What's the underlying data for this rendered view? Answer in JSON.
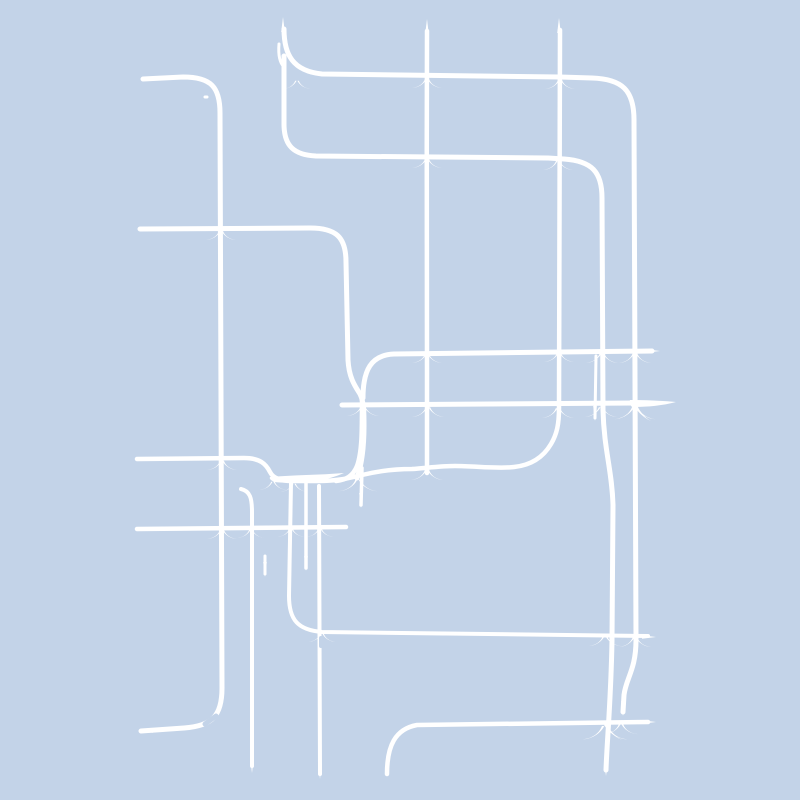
{
  "page": {
    "title": "Abstract white pipe-line artwork on pale blue background"
  },
  "canvas": {
    "width": 800,
    "height": 800,
    "background_color": "#c3d3e8",
    "line_color": "#ffffff"
  },
  "artwork": {
    "description": "Abstract generative line art: a tangle of white pipe-like lines with rounded corners, tapered needle ends and calligraphic claw flares at intersections, drawn on a pale periwinkle-blue background",
    "strokes": [
      {
        "name": "left-frame",
        "w": 5,
        "d": "M 143,79 L 183,77 C 211,77 220,87 220,113 L 222,688 C 222,716 212,726 184,728 L 141,731"
      },
      {
        "name": "h228-to-wiggle-down",
        "w": 5,
        "d": "M 140,229 L 310,228 C 336,228 346,237 346,262 L 348,360 C 349,378 355,386 360,394 C 364,402 364,412 364,426 C 364,448 362,464 357,478"
      },
      {
        "name": "top-hook-h75-v635",
        "w": 5,
        "d": "M 284,29 C 284,55 293,71 322,74 L 560,77 L 592,78 C 622,79 634,90 634,120 L 636,640 C 636,670 626,678 624,695 L 623,712"
      },
      {
        "name": "cshape-h156-v603",
        "w": 5,
        "d": "M 284,56 L 284,124 C 284,146 294,155 316,156 L 548,158 L 564,159 C 592,161 602,172 602,198 L 603,410 C 604,450 612,470 613,505 L 612,640 C 611,700 607,740 606,770"
      },
      {
        "name": "v427",
        "w": 4.5,
        "d": "M 427,31 C 426,150 428,300 427,380 L 427,473"
      },
      {
        "name": "meander-h458-v559",
        "w": 4.5,
        "d": "M 137,459 L 244,458 C 260,458 266,464 270,472 C 273,478 281,481 292,481 L 318,481 C 338,481 350,478 362,475 C 382,470 397,469 412,469 C 427,468 440,466 455,466 C 475,466 498,469 514,467 C 533,465 544,456 551,444 C 557,434 559,424 559,408 L 560,30"
      },
      {
        "name": "h1-y351",
        "w": 5,
        "d": "M 363,398 C 363,370 371,355 394,354 L 652,351"
      },
      {
        "name": "h1-left-descender",
        "w": 4.5,
        "d": "M 362,400 C 362,432 362,452 357,466 C 353,476 346,480 336,481"
      },
      {
        "name": "h2-y403",
        "w": 5,
        "d": "M 342,405 L 638,403"
      },
      {
        "name": "h527",
        "w": 4.5,
        "d": "M 137,529 L 346,527"
      },
      {
        "name": "v291-corner-h632",
        "w": 4,
        "d": "M 291,483 L 289,596 C 289,620 298,630 322,632 L 648,636"
      },
      {
        "name": "v320",
        "w": 4,
        "d": "M 319,486 L 320,774"
      },
      {
        "name": "v306-stub",
        "w": 3.5,
        "d": "M 306,482 L 306,568"
      },
      {
        "name": "v250",
        "w": 4,
        "d": "M 241,489 C 250,491 252,498 252,512 L 252,766"
      },
      {
        "name": "h723-corner",
        "w": 4.5,
        "d": "M 387,774 C 387,746 395,729 417,725 L 648,722"
      },
      {
        "name": "stub-595",
        "w": 3,
        "d": "M 596,356 L 595,418"
      },
      {
        "name": "stub-265",
        "w": 3,
        "d": "M 265,556 L 265,574"
      },
      {
        "name": "double-stroke-top",
        "w": 3,
        "d": "M 279,44 C 278,56 280,63 284,67"
      },
      {
        "name": "descender-stub-361",
        "w": 3.5,
        "d": "M 362,468 L 361,505"
      },
      {
        "name": "dot",
        "w": 3,
        "d": "M 205,97 L 207,97"
      }
    ],
    "flares": [
      {
        "name": "h2-right-spike",
        "d": "M 630,400 C 650,400 664,401 676,402 C 661,406 645,407 632,407 C 629,404 629,402 630,400 Z"
      },
      {
        "name": "knot-swell",
        "d": "M 270,477 C 292,475 320,475 344,473 C 322,483 295,484 274,482 C 271,480 269,479 270,477 Z"
      },
      {
        "name": "h2-droop",
        "d": "M 636,404 C 640,412 645,418 651,421 C 644,418 638,412 634,406 Z"
      },
      {
        "name": "h723-droop",
        "d": "M 606,723 C 610,731 616,737 622,740 C 615,737 608,731 604,725 Z"
      }
    ],
    "crossings": [
      {
        "x": 427,
        "y": 77,
        "s": 1
      },
      {
        "x": 560,
        "y": 78,
        "s": 1
      },
      {
        "x": 427,
        "y": 157,
        "s": 1
      },
      {
        "x": 558,
        "y": 159,
        "s": 1
      },
      {
        "x": 221,
        "y": 229,
        "s": 1
      },
      {
        "x": 297,
        "y": 79,
        "s": 0.9
      },
      {
        "x": 427,
        "y": 352,
        "s": 1
      },
      {
        "x": 559,
        "y": 351,
        "s": 1
      },
      {
        "x": 602,
        "y": 351,
        "s": 1.1
      },
      {
        "x": 635,
        "y": 351,
        "s": 1.1
      },
      {
        "x": 428,
        "y": 405,
        "s": 1.1
      },
      {
        "x": 558,
        "y": 406,
        "s": 1.1
      },
      {
        "x": 601,
        "y": 405,
        "s": 1.1
      },
      {
        "x": 635,
        "y": 404,
        "s": 1.4
      },
      {
        "x": 363,
        "y": 404,
        "s": 1.1
      },
      {
        "x": 222,
        "y": 459,
        "s": 1
      },
      {
        "x": 427,
        "y": 468,
        "s": 1.1
      },
      {
        "x": 358,
        "y": 477,
        "s": 1.3
      },
      {
        "x": 294,
        "y": 482,
        "s": 0.9
      },
      {
        "x": 273,
        "y": 480,
        "s": 0.9
      },
      {
        "x": 222,
        "y": 528,
        "s": 1
      },
      {
        "x": 251,
        "y": 528,
        "s": 0.9
      },
      {
        "x": 291,
        "y": 527,
        "s": 0.9
      },
      {
        "x": 320,
        "y": 527,
        "s": 0.9
      },
      {
        "x": 322,
        "y": 632,
        "s": 0.9
      },
      {
        "x": 605,
        "y": 634,
        "s": 1.1
      },
      {
        "x": 635,
        "y": 635,
        "s": 1.1
      },
      {
        "x": 605,
        "y": 723,
        "s": 1.5
      },
      {
        "x": 621,
        "y": 722,
        "s": 1.1
      }
    ],
    "spikes": [
      {
        "x": 283,
        "y": 17,
        "dir": "up"
      },
      {
        "x": 427,
        "y": 19,
        "dir": "up"
      },
      {
        "x": 559,
        "y": 18,
        "dir": "up"
      },
      {
        "x": 252,
        "y": 773,
        "dir": "down"
      },
      {
        "x": 320,
        "y": 779,
        "dir": "down"
      },
      {
        "x": 606,
        "y": 776,
        "dir": "down"
      },
      {
        "x": 623,
        "y": 716,
        "dir": "down"
      },
      {
        "x": 361,
        "y": 508,
        "dir": "down"
      },
      {
        "x": 595,
        "y": 421,
        "dir": "down"
      },
      {
        "x": 265,
        "y": 577,
        "dir": "down"
      },
      {
        "x": 306,
        "y": 571,
        "dir": "down"
      },
      {
        "x": 135,
        "y": 459,
        "dir": "left"
      },
      {
        "x": 135,
        "y": 529,
        "dir": "left"
      },
      {
        "x": 138,
        "y": 229,
        "dir": "left"
      },
      {
        "x": 139,
        "y": 731,
        "dir": "left"
      },
      {
        "x": 141,
        "y": 78,
        "dir": "left"
      },
      {
        "x": 660,
        "y": 351,
        "dir": "right"
      },
      {
        "x": 656,
        "y": 637,
        "dir": "right"
      },
      {
        "x": 656,
        "y": 722,
        "dir": "right"
      }
    ],
    "gaps": [
      {
        "d": "M 205,724 L 216,716",
        "w": 5
      },
      {
        "d": "M 321,638 L 321,646",
        "w": 4
      }
    ]
  }
}
